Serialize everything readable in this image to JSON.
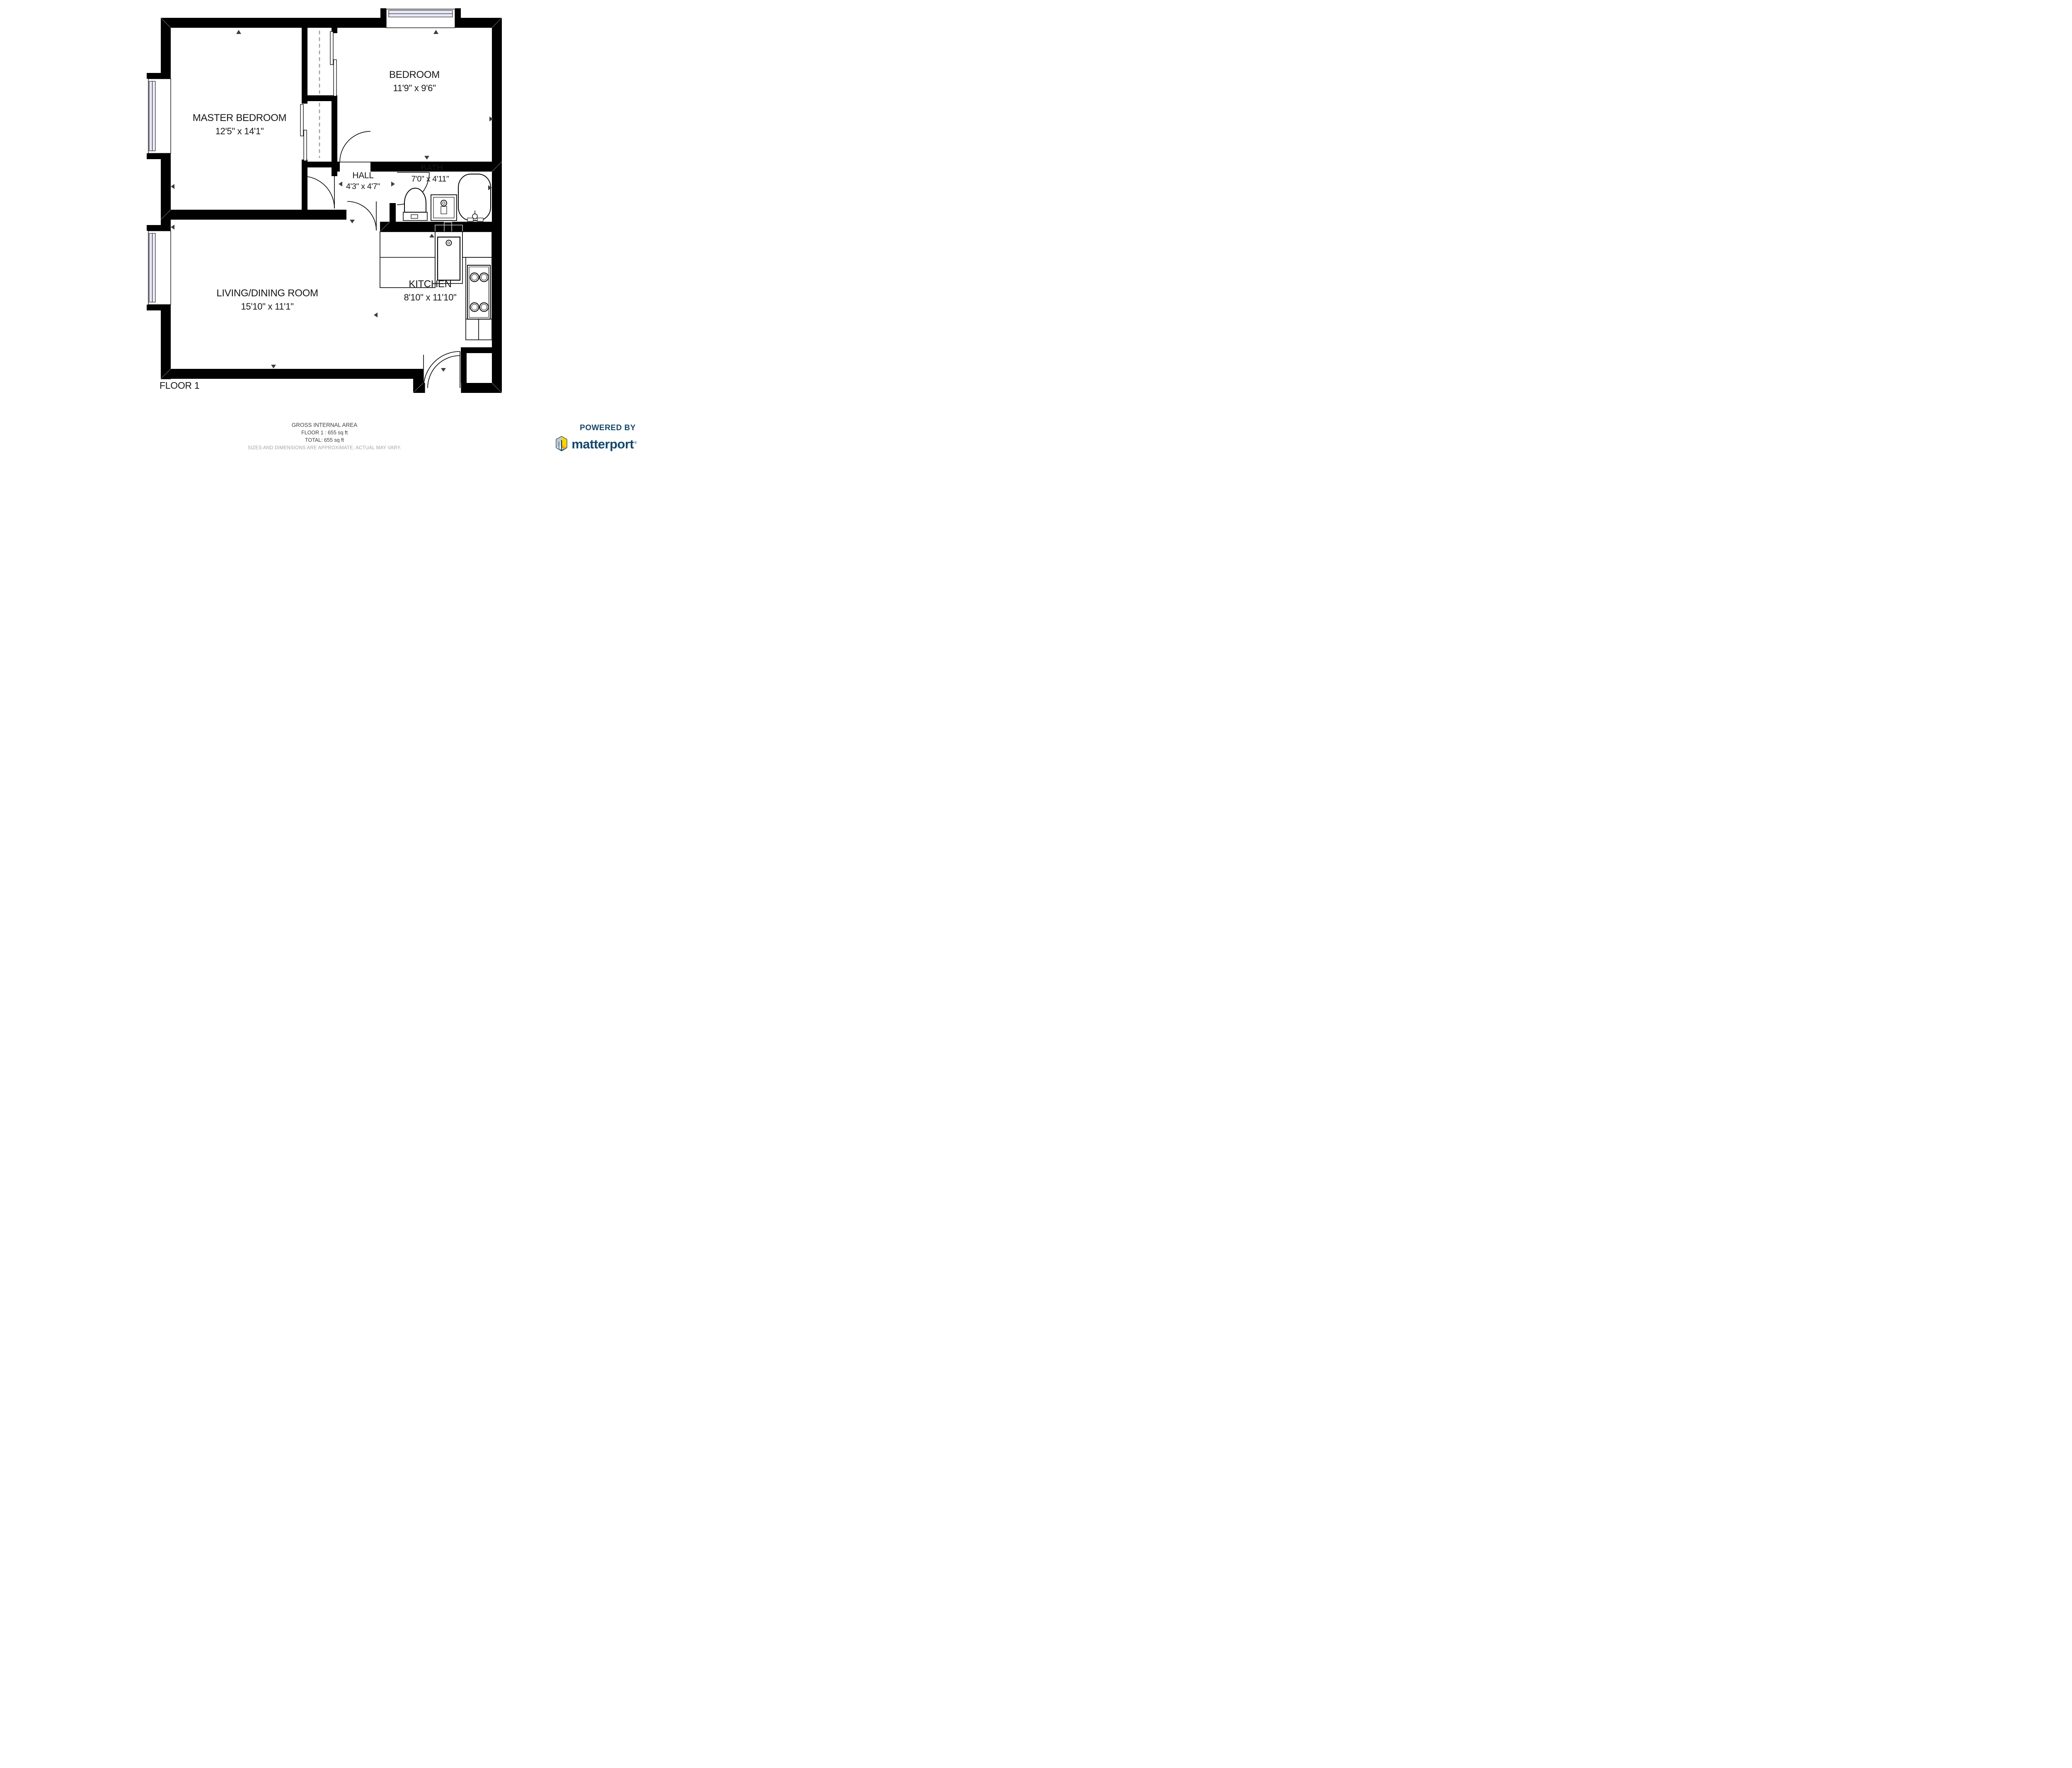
{
  "floor_plan": {
    "floor_label": "FLOOR 1",
    "rooms": [
      {
        "id": "master-bedroom",
        "name": "MASTER BEDROOM",
        "dimensions": "12'5\" x 14'1\""
      },
      {
        "id": "bedroom",
        "name": "BEDROOM",
        "dimensions": "11'9\" x 9'6\""
      },
      {
        "id": "hall",
        "name": "HALL",
        "dimensions": "4'3\" x 4'7\""
      },
      {
        "id": "bath",
        "name": "BATH",
        "dimensions": "7'0\" x 4'11\""
      },
      {
        "id": "living-dining",
        "name": "LIVING/DINING ROOM",
        "dimensions": "15'10\" x 11'1\""
      },
      {
        "id": "kitchen",
        "name": "KITCHEN",
        "dimensions": "8'10\" x 11'10\""
      }
    ],
    "fixtures": [
      "toilet",
      "sink-vanity",
      "bathtub",
      "kitchen-sink",
      "stove-4-burner",
      "closet-sliding-doors",
      "entry-door",
      "windows"
    ]
  },
  "footer": {
    "area_title": "GROSS INTERNAL AREA",
    "floor_area": "FLOOR 1 : 655 sq ft",
    "total_area": "TOTAL: 655 sq ft",
    "disclaimer": "SIZES AND DIMENSIONS ARE APPROXIMATE, ACTUAL MAY VARY."
  },
  "branding": {
    "powered_by": "POWERED BY",
    "brand": "matterport",
    "registered": "®"
  },
  "colors": {
    "wall": "#000000",
    "window_glass": "#e9e8f8",
    "brand_navy": "#15476b",
    "brand_yellow": "#ffd400",
    "brand_orange": "#f7a600",
    "brand_gray": "#c7c8ca",
    "disclaimer_gray": "#a3a3a3",
    "arrow": "#3d3d3d"
  }
}
